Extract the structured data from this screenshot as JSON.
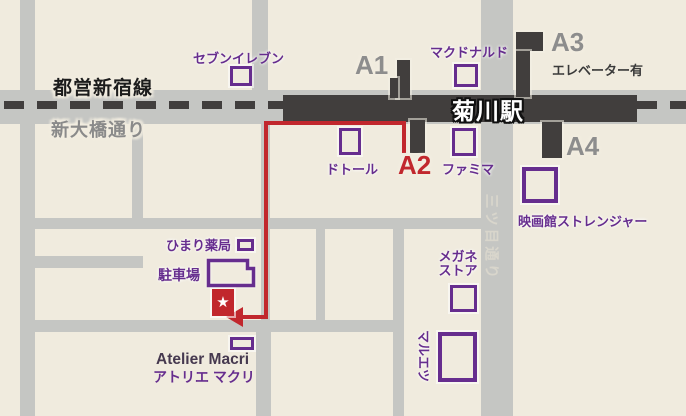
{
  "palette": {
    "background_beige": "#f0ebde",
    "street_gray": "#c5c6c3",
    "station_dark": "#413e3d",
    "poi_purple": "#662d8e",
    "route_red": "#c1272d",
    "exit_label_gray": "#8d8d8d",
    "road_label_gray": "#8a8a8a",
    "atelier_en_color": "#46394f"
  },
  "map": {
    "railway_label": "都営新宿線",
    "road_label": "新大橋通り",
    "station_label": "菊川駅",
    "vertical_street_label": "三ツ目通り",
    "exits": {
      "a1": "A1",
      "a2": "A2",
      "a3": "A3",
      "a4": "A4",
      "a3_note": "エレベーター有"
    },
    "pois": {
      "seven_eleven": "セブンイレブン",
      "mcdonalds": "マクドナルド",
      "doutor": "ドトール",
      "famima": "ファミマ",
      "cinema": "映画館ストレンジャー",
      "megane_line1": "メガネ",
      "megane_line2": "ストア",
      "maruetsu": "マルエツ",
      "himari_pharmacy": "ひまり薬局",
      "parking": "駐車場"
    },
    "destination": {
      "name_en": "Atelier Macri",
      "name_ja": "アトリエ マクリ",
      "star_glyph": "★"
    }
  }
}
